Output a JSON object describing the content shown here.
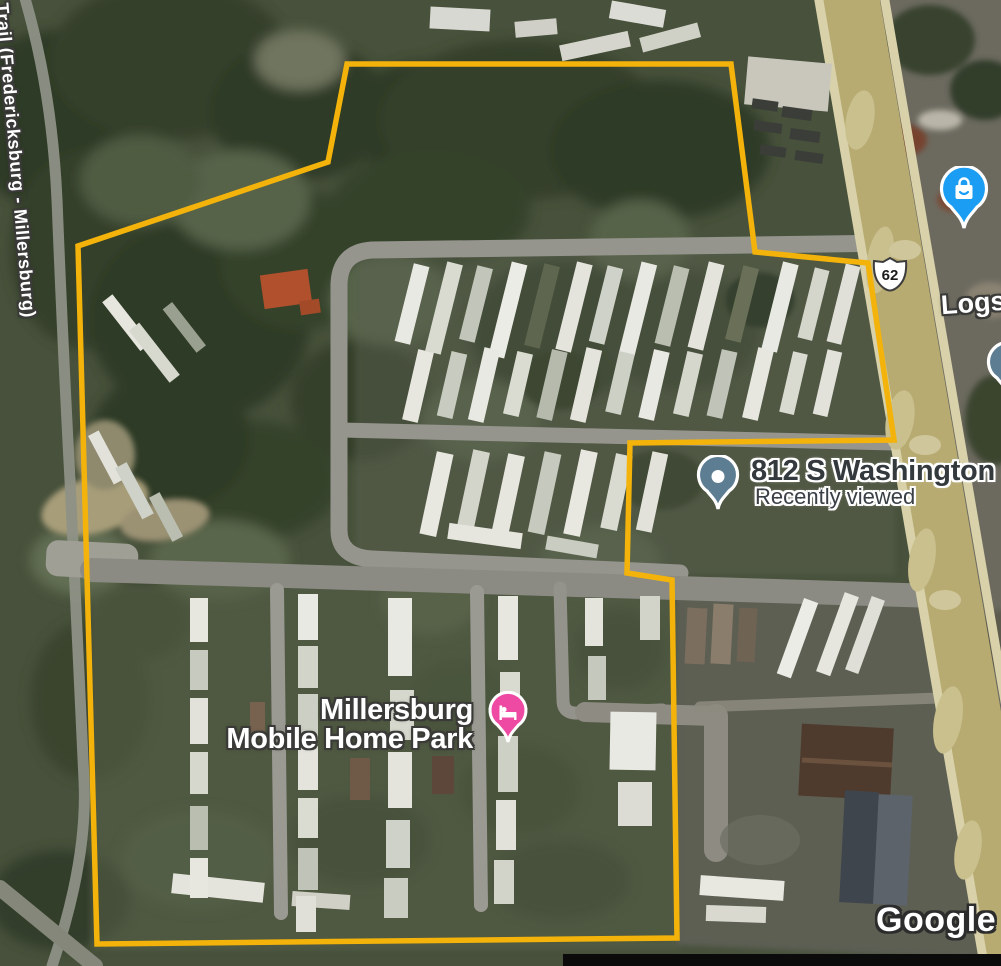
{
  "map_labels": {
    "trail": "Trail (Fredericksburg - Millersburg)",
    "route_shield": "62",
    "business_partial": "Logs",
    "address_title": "812 S Washington S",
    "address_subtitle": "Recently viewed",
    "park_line1": "Millersburg",
    "park_line2": "Mobile Home Park"
  },
  "watermark": "Google",
  "icons": {
    "shopping_pin": "shopping-bag",
    "address_pin": "circle-dot",
    "partial_pin": "circle-dot",
    "lodging_pin": "bed"
  },
  "colors": {
    "boundary_yellow": "#F3B30A",
    "shopping_pin_blue": "#1B9DF3",
    "address_pin_slate": "#5C7D92",
    "lodging_pin_pink": "#EE4AA3",
    "highway_tan": "#B7AB72",
    "road_gray": "#95958E",
    "label_dark_gray": "#33393D"
  }
}
